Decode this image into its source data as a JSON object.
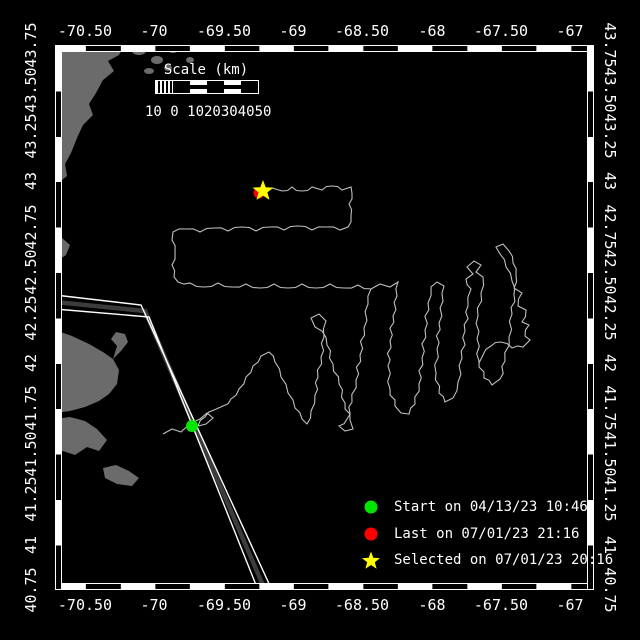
{
  "colors": {
    "background": "#000000",
    "land": "#6b6b6b",
    "track": "#c0c0c0",
    "frame": "#ffffff",
    "start": "#00e600",
    "last": "#ff0000",
    "selected": "#ffff00",
    "lane_core": "#3c3c3c"
  },
  "axes": {
    "top_labels": [
      "-70.50",
      "-70",
      "-69.50",
      "-69",
      "-68.50",
      "-68",
      "-67.50",
      "-67"
    ],
    "bottom_labels": [
      "-70.50",
      "-70",
      "-69.50",
      "-69",
      "-68.50",
      "-68",
      "-67.50",
      "-67"
    ],
    "left_labels": [
      "43.75",
      "43.50",
      "43.25",
      "43",
      "42.75",
      "42.50",
      "42.25",
      "42",
      "41.75",
      "41.50",
      "41.25",
      "41",
      "40.75"
    ],
    "right_labels": [
      "43.75",
      "43.50",
      "43.25",
      "43",
      "42.75",
      "42.50",
      "42.25",
      "42",
      "41.75",
      "41.50",
      "41.25",
      "41",
      "40.75"
    ],
    "lon_x": [
      85,
      154,
      224,
      293,
      362,
      432,
      501,
      570
    ],
    "lat_y": [
      45,
      90,
      136,
      181,
      227,
      272,
      318,
      363,
      408,
      454,
      499,
      545,
      590
    ],
    "lon_range": [
      -70.72,
      -66.86
    ],
    "lat_range": [
      40.75,
      43.75
    ]
  },
  "scale_bar": {
    "title": "Scale (km)",
    "numbers": "10 0 1020304050"
  },
  "legend": [
    {
      "marker": "circle",
      "color": "#00e600",
      "label": "Start on 04/13/23 10:46"
    },
    {
      "marker": "circle",
      "color": "#ff0000",
      "label": "Last on 07/01/23 21:16"
    },
    {
      "marker": "star",
      "color": "#ffff00",
      "label": "Selected on 07/01/23 20:16"
    }
  ],
  "markers": {
    "start": {
      "x": 192,
      "y": 426,
      "r": 6
    },
    "last": {
      "x": 259,
      "y": 193,
      "r": 5.5
    },
    "selected": {
      "x": 263,
      "y": 191,
      "r": 11
    }
  },
  "map": {
    "frame": {
      "x": 55,
      "y": 45,
      "w": 538,
      "h": 545
    },
    "track": [
      [
        [
          163,
          434
        ],
        [
          172,
          429
        ],
        [
          181,
          432
        ],
        [
          192,
          426
        ],
        [
          200,
          419
        ],
        [
          207,
          413
        ],
        [
          213,
          418
        ],
        [
          206,
          424
        ],
        [
          198,
          426
        ],
        [
          205,
          417
        ],
        [
          214,
          410
        ],
        [
          223,
          406
        ],
        [
          231,
          399
        ],
        [
          239,
          389
        ],
        [
          246,
          377
        ],
        [
          253,
          366
        ],
        [
          261,
          356
        ],
        [
          269,
          352
        ],
        [
          275,
          362
        ],
        [
          281,
          377
        ],
        [
          288,
          393
        ],
        [
          295,
          408
        ],
        [
          302,
          419
        ],
        [
          307,
          424
        ],
        [
          311,
          411
        ],
        [
          315,
          395
        ],
        [
          318,
          377
        ],
        [
          321,
          357
        ],
        [
          324,
          337
        ],
        [
          326,
          321
        ],
        [
          319,
          314
        ],
        [
          311,
          318
        ],
        [
          315,
          327
        ],
        [
          322,
          331
        ],
        [
          327,
          345
        ],
        [
          333,
          364
        ],
        [
          339,
          384
        ],
        [
          345,
          403
        ],
        [
          350,
          420
        ],
        [
          353,
          429
        ],
        [
          345,
          431
        ],
        [
          339,
          426
        ],
        [
          347,
          419
        ],
        [
          352,
          402
        ],
        [
          356,
          380
        ],
        [
          360,
          355
        ],
        [
          364,
          328
        ],
        [
          368,
          304
        ],
        [
          371,
          289
        ],
        [
          358,
          285
        ],
        [
          344,
          288
        ],
        [
          330,
          284
        ],
        [
          316,
          288
        ],
        [
          302,
          284
        ],
        [
          288,
          288
        ],
        [
          274,
          284
        ],
        [
          260,
          288
        ],
        [
          246,
          284
        ],
        [
          232,
          287
        ],
        [
          218,
          283
        ],
        [
          204,
          287
        ],
        [
          190,
          283
        ],
        [
          178,
          282
        ],
        [
          174,
          277
        ],
        [
          172,
          265
        ],
        [
          175,
          252
        ],
        [
          172,
          240
        ],
        [
          173,
          232
        ],
        [
          186,
          229
        ],
        [
          200,
          232
        ],
        [
          214,
          228
        ],
        [
          228,
          231
        ],
        [
          242,
          227
        ],
        [
          256,
          231
        ],
        [
          270,
          227
        ],
        [
          284,
          230
        ],
        [
          298,
          226
        ],
        [
          312,
          230
        ],
        [
          326,
          227
        ],
        [
          340,
          230
        ],
        [
          348,
          227
        ],
        [
          351,
          216
        ],
        [
          349,
          204
        ],
        [
          352,
          193
        ],
        [
          351,
          187
        ],
        [
          342,
          190
        ],
        [
          332,
          186
        ],
        [
          322,
          190
        ],
        [
          312,
          187
        ],
        [
          302,
          191
        ],
        [
          292,
          187
        ],
        [
          282,
          191
        ],
        [
          272,
          188
        ],
        [
          264,
          191
        ]
      ],
      [
        [
          371,
          289
        ],
        [
          380,
          284
        ],
        [
          390,
          287
        ],
        [
          398,
          282
        ],
        [
          397,
          296
        ],
        [
          393,
          316
        ],
        [
          390,
          341
        ],
        [
          388,
          366
        ],
        [
          390,
          389
        ],
        [
          395,
          406
        ],
        [
          401,
          413
        ],
        [
          409,
          414
        ],
        [
          415,
          404
        ],
        [
          419,
          384
        ],
        [
          422,
          358
        ],
        [
          425,
          330
        ],
        [
          428,
          303
        ],
        [
          431,
          287
        ],
        [
          437,
          282
        ],
        [
          444,
          286
        ],
        [
          443,
          301
        ],
        [
          439,
          323
        ],
        [
          437,
          349
        ],
        [
          436,
          373
        ],
        [
          439,
          393
        ],
        [
          445,
          402
        ],
        [
          453,
          398
        ],
        [
          458,
          382
        ],
        [
          462,
          358
        ],
        [
          465,
          331
        ],
        [
          468,
          306
        ],
        [
          471,
          289
        ],
        [
          466,
          279
        ],
        [
          473,
          274
        ],
        [
          467,
          267
        ],
        [
          474,
          261
        ],
        [
          481,
          265
        ],
        [
          476,
          272
        ],
        [
          483,
          277
        ],
        [
          481,
          293
        ],
        [
          478,
          316
        ],
        [
          477,
          339
        ],
        [
          479,
          361
        ],
        [
          484,
          378
        ],
        [
          492,
          385
        ],
        [
          500,
          379
        ],
        [
          505,
          361
        ],
        [
          509,
          337
        ],
        [
          512,
          314
        ],
        [
          514,
          295
        ],
        [
          512,
          281
        ],
        [
          506,
          267
        ],
        [
          500,
          254
        ],
        [
          496,
          247
        ],
        [
          503,
          244
        ],
        [
          509,
          251
        ],
        [
          513,
          263
        ],
        [
          516,
          275
        ],
        [
          514,
          288
        ],
        [
          522,
          293
        ],
        [
          518,
          306
        ],
        [
          526,
          310
        ],
        [
          522,
          322
        ],
        [
          529,
          325
        ],
        [
          525,
          336
        ],
        [
          530,
          340
        ],
        [
          523,
          347
        ],
        [
          512,
          348
        ],
        [
          501,
          342
        ],
        [
          491,
          346
        ],
        [
          483,
          355
        ],
        [
          479,
          363
        ]
      ]
    ],
    "land": [
      [
        [
          55,
          45
        ],
        [
          124,
          45
        ],
        [
          119,
          55
        ],
        [
          108,
          61
        ],
        [
          114,
          71
        ],
        [
          103,
          80
        ],
        [
          96,
          93
        ],
        [
          89,
          104
        ],
        [
          93,
          115
        ],
        [
          83,
          125
        ],
        [
          77,
          138
        ],
        [
          71,
          153
        ],
        [
          65,
          164
        ],
        [
          67,
          176
        ],
        [
          57,
          184
        ],
        [
          55,
          184
        ]
      ],
      [
        [
          51,
          242
        ],
        [
          62,
          238
        ],
        [
          70,
          245
        ],
        [
          66,
          255
        ],
        [
          57,
          261
        ],
        [
          49,
          256
        ]
      ],
      [
        [
          55,
          330
        ],
        [
          72,
          336
        ],
        [
          89,
          344
        ],
        [
          103,
          352
        ],
        [
          113,
          359
        ],
        [
          121,
          351
        ],
        [
          128,
          342
        ],
        [
          125,
          334
        ],
        [
          116,
          332
        ],
        [
          111,
          339
        ],
        [
          117,
          346
        ],
        [
          113,
          359
        ],
        [
          119,
          370
        ],
        [
          117,
          384
        ],
        [
          109,
          394
        ],
        [
          99,
          401
        ],
        [
          85,
          407
        ],
        [
          70,
          411
        ],
        [
          55,
          413
        ]
      ],
      [
        [
          55,
          419
        ],
        [
          70,
          417
        ],
        [
          85,
          421
        ],
        [
          97,
          429
        ],
        [
          107,
          440
        ],
        [
          99,
          451
        ],
        [
          87,
          447
        ],
        [
          75,
          455
        ],
        [
          63,
          451
        ],
        [
          55,
          455
        ]
      ],
      [
        [
          103,
          468
        ],
        [
          116,
          465
        ],
        [
          129,
          471
        ],
        [
          139,
          478
        ],
        [
          132,
          486
        ],
        [
          117,
          484
        ],
        [
          105,
          478
        ]
      ]
    ],
    "speckles": [
      [
        139,
        51,
        7,
        4
      ],
      [
        157,
        60,
        6,
        4
      ],
      [
        173,
        50,
        5,
        3
      ],
      [
        149,
        71,
        5,
        3
      ],
      [
        190,
        60,
        4,
        3
      ],
      [
        168,
        68,
        4,
        3
      ]
    ],
    "lane": {
      "white1": [
        [
          55,
          295
        ],
        [
          141,
          305
        ],
        [
          271,
          588
        ]
      ],
      "core": [
        [
          55,
          302
        ],
        [
          145,
          311
        ],
        [
          265,
          590
        ]
      ],
      "white2": [
        [
          55,
          309
        ],
        [
          149,
          317
        ],
        [
          258,
          590
        ]
      ]
    }
  }
}
